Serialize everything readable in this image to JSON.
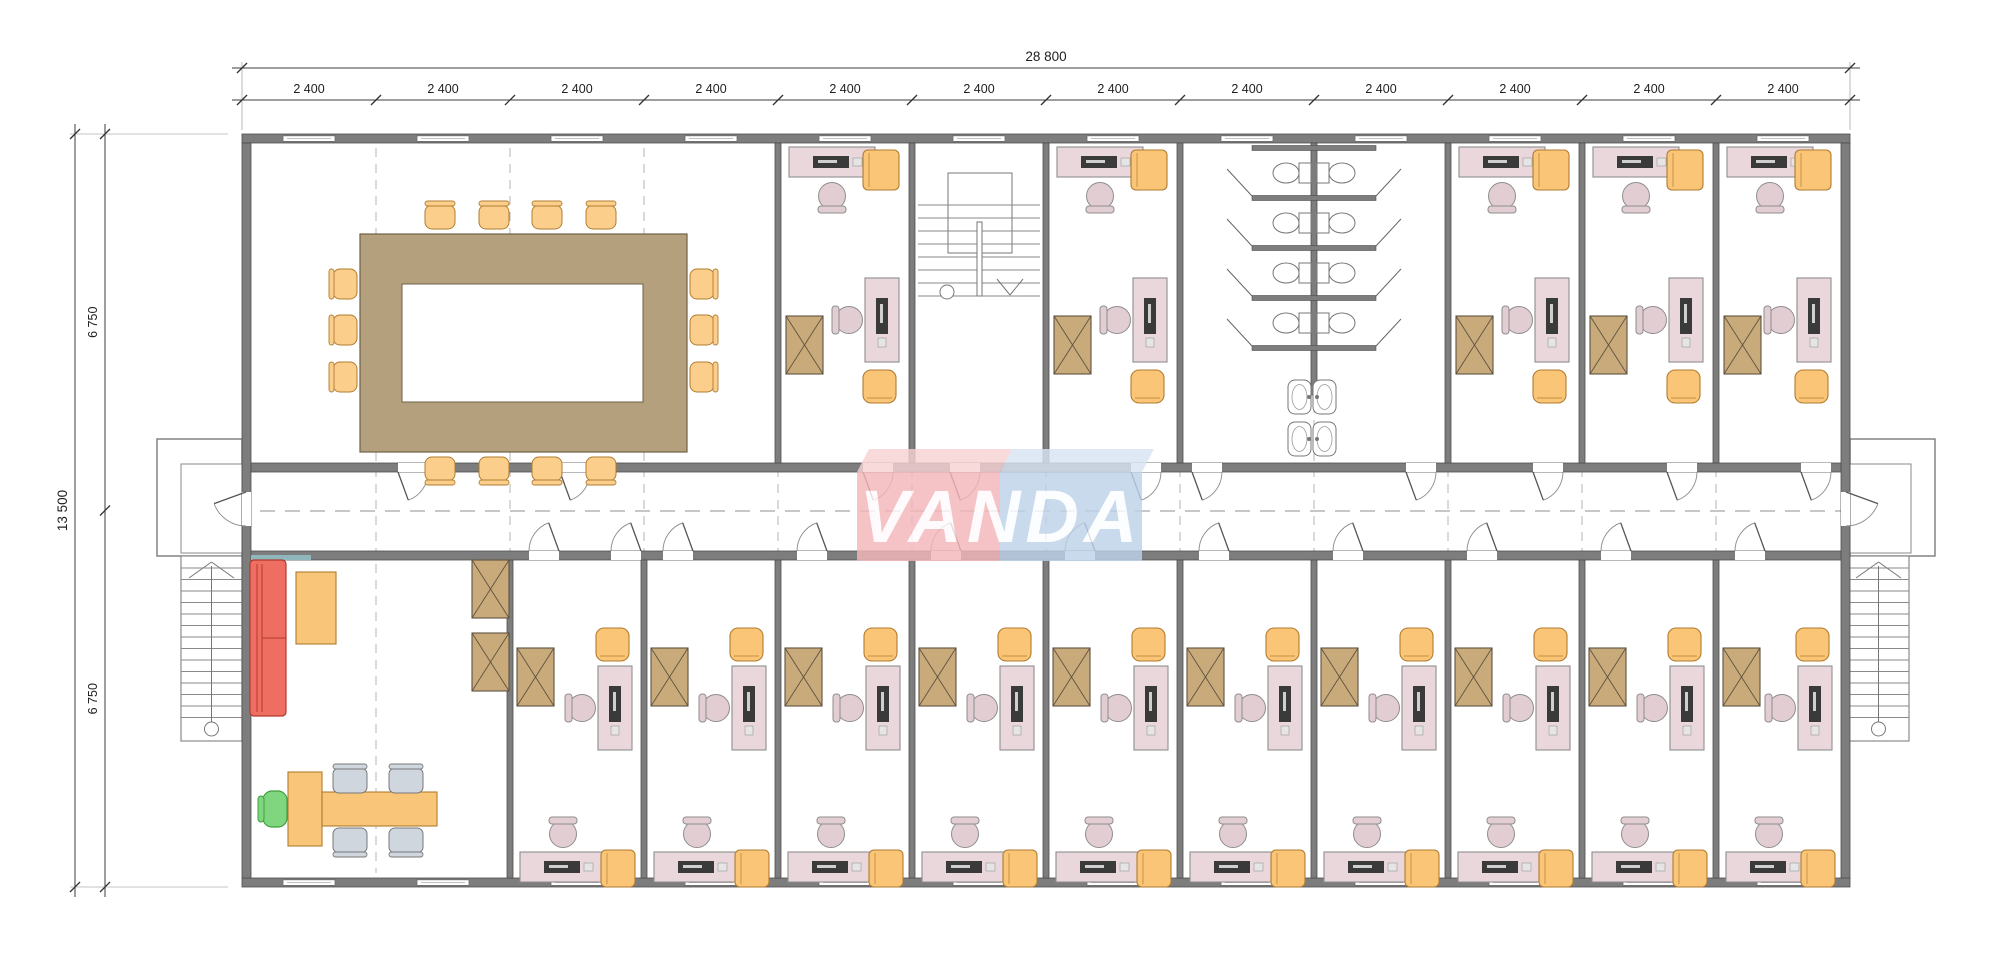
{
  "logo": {
    "text": "VANDA",
    "block_left_color": "#f4b6ba",
    "block_left_top_color": "#f8d2d4",
    "block_right_color": "#bed2ea",
    "block_right_top_color": "#d9e4f4",
    "letter_color": "#ffffff"
  },
  "dimensions": {
    "total_width_label": "28 800",
    "module_labels": [
      "2 400",
      "2 400",
      "2 400",
      "2 400",
      "2 400",
      "2 400",
      "2 400",
      "2 400",
      "2 400",
      "2 400",
      "2 400",
      "2 400"
    ],
    "total_height_label": "13 500",
    "half_height_labels": [
      "6 750",
      "6 750"
    ]
  },
  "plan": {
    "modules_across": 12,
    "top_row_rooms": [
      {
        "type": "meeting-room",
        "modules": 4
      },
      {
        "type": "office",
        "modules": 1
      },
      {
        "type": "stairwell",
        "modules": 1
      },
      {
        "type": "office",
        "modules": 1
      },
      {
        "type": "toilets",
        "modules": 2
      },
      {
        "type": "office",
        "modules": 1
      },
      {
        "type": "office",
        "modules": 1
      },
      {
        "type": "office",
        "modules": 1
      }
    ],
    "bottom_row_rooms": [
      {
        "type": "lounge",
        "modules": 2
      },
      {
        "type": "office",
        "modules": 1
      },
      {
        "type": "office",
        "modules": 1
      },
      {
        "type": "office",
        "modules": 1
      },
      {
        "type": "office",
        "modules": 1
      },
      {
        "type": "office",
        "modules": 1
      },
      {
        "type": "office",
        "modules": 1
      },
      {
        "type": "office",
        "modules": 1
      },
      {
        "type": "office",
        "modules": 1
      },
      {
        "type": "office",
        "modules": 1
      },
      {
        "type": "office",
        "modules": 1
      }
    ],
    "meeting_room": {
      "table": "rectangular-ring",
      "chairs_top": 4,
      "chairs_bottom": 4,
      "chairs_left": 3,
      "chairs_right": 3
    },
    "toilets": {
      "stall_rows": 4,
      "toilets": 8,
      "sinks": 4
    },
    "external_stairs": 2,
    "corridor": "central"
  },
  "colors": {
    "wall": "#7d7d7d",
    "wall_edge": "#4e4e4e",
    "floor": "#ffffff",
    "desk": "#e9d7db",
    "desk_edge": "#8e8e8e",
    "chair": "#e2cdd3",
    "cabinet_yellow": "#fbc578",
    "cabinet_yellow_edge": "#b07c2f",
    "cabinet_wood": "#c9aa7b",
    "cabinet_wood_edge": "#5f5340",
    "meeting_table": "#b5a07d",
    "meeting_table_edge": "#6e6048",
    "meeting_chair": "#fcce8c",
    "sofa": "#ee6f62",
    "sofa_edge": "#b2392e",
    "coffee_table": "#f9c579",
    "guest_chair": "#cfd6de",
    "exec_chair": "#80d67e",
    "monitor": "#3a3a3a",
    "gridline": "#b5b5b5",
    "dimension": "#1e1e1e",
    "stair_line": "#8a8a8a",
    "accent_wall": "#8fb6ba"
  }
}
